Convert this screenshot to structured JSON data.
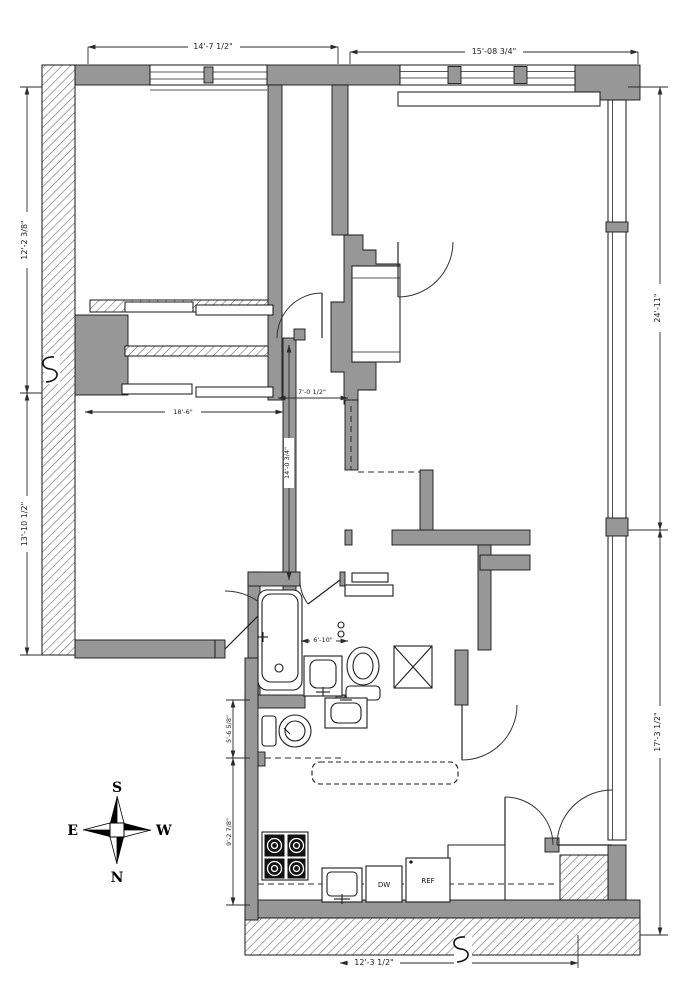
{
  "drawing": {
    "kind": "apartment-floor-plan",
    "dimensions": {
      "top_left": "14'-7 1/2\"",
      "top_right": "15'-08 3/4\"",
      "left_upper": "12'-2 3/8\"",
      "left_lower": "13'-10 1/2\"",
      "right_upper": "24'-11\"",
      "right_lower": "17'-3 1/2\"",
      "entry": "7'-0 1/2\"",
      "hall_vertical": "14'-0 3/4\"",
      "bedroom2_width": "18'-6\"",
      "bathroom": "6'-10\"",
      "powder_room": "5'-6 5/8\"",
      "kitchen": "9'-2 7/8\"",
      "bottom": "12'-3 1/2\""
    },
    "appliances": {
      "dishwasher": "DW",
      "refrigerator": "REF"
    },
    "compass": {
      "north": "N",
      "south": "S",
      "east": "E",
      "west": "W"
    },
    "colors": {
      "wall_gray": "#979797",
      "line": "#161616",
      "background": "#ffffff"
    }
  }
}
